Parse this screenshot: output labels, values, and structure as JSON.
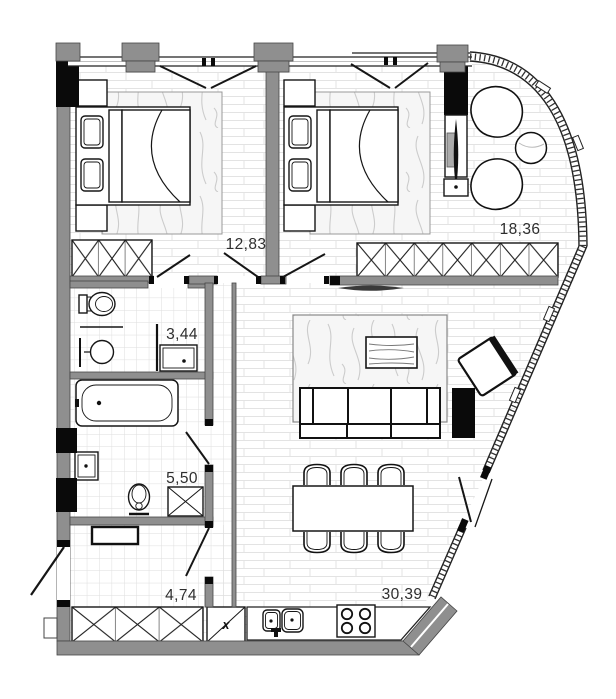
{
  "plan": {
    "rooms": [
      {
        "id": "bedroom-1",
        "area_label": "12,83"
      },
      {
        "id": "bedroom-2",
        "area_label": "18,36"
      },
      {
        "id": "bathroom-1",
        "area_label": "3,44"
      },
      {
        "id": "bathroom-2",
        "area_label": "5,50"
      },
      {
        "id": "hallway",
        "area_label": "4,74"
      },
      {
        "id": "living-kitchen",
        "area_label": "30,39"
      }
    ],
    "marks": {
      "appliance_x": "x"
    },
    "colors": {
      "background": "#ffffff",
      "wall_gray": "#8f8f8f",
      "shaft_black": "#0a0a0a",
      "brick_line": "#e3e3e3",
      "tile_line": "#dedede",
      "marble_vein": "#cccccc",
      "label_text": "#2e2e2e"
    }
  }
}
